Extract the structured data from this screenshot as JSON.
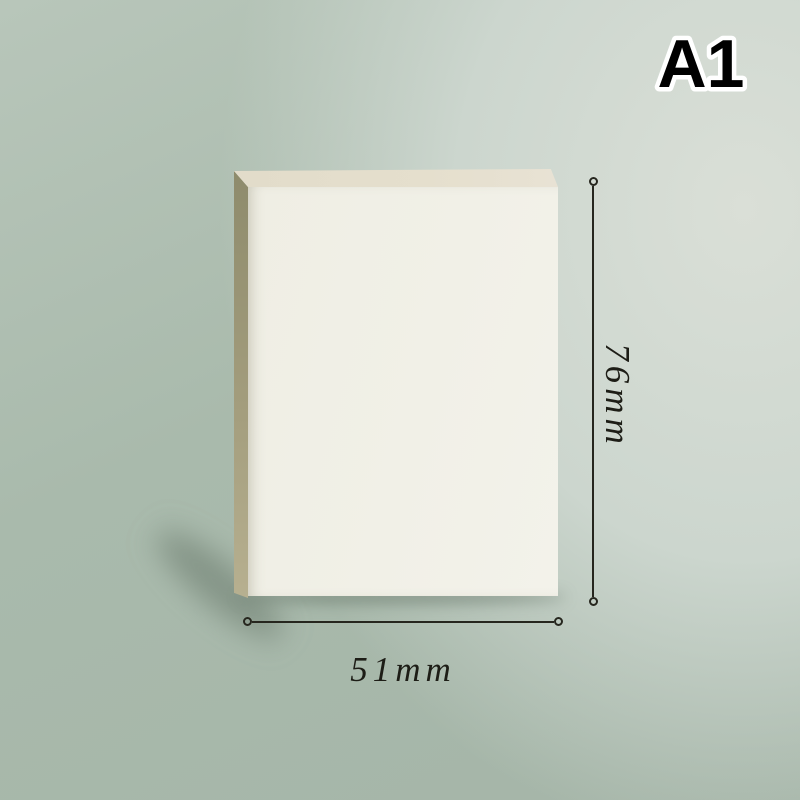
{
  "variant_label": "A1",
  "dimensions": {
    "height_label": "76mm",
    "width_label": "51mm"
  },
  "colors": {
    "background_base": "#a5b5a8",
    "background_highlight": "#dadfd7",
    "pad_front": "#f1f0e7",
    "pad_top": "#e5dfcd",
    "pad_side_top": "#8e8b6c",
    "pad_side_bottom": "#b7b090",
    "dimension_line": "#26261e",
    "variant_text": "#000000",
    "variant_outline": "#ffffff"
  }
}
